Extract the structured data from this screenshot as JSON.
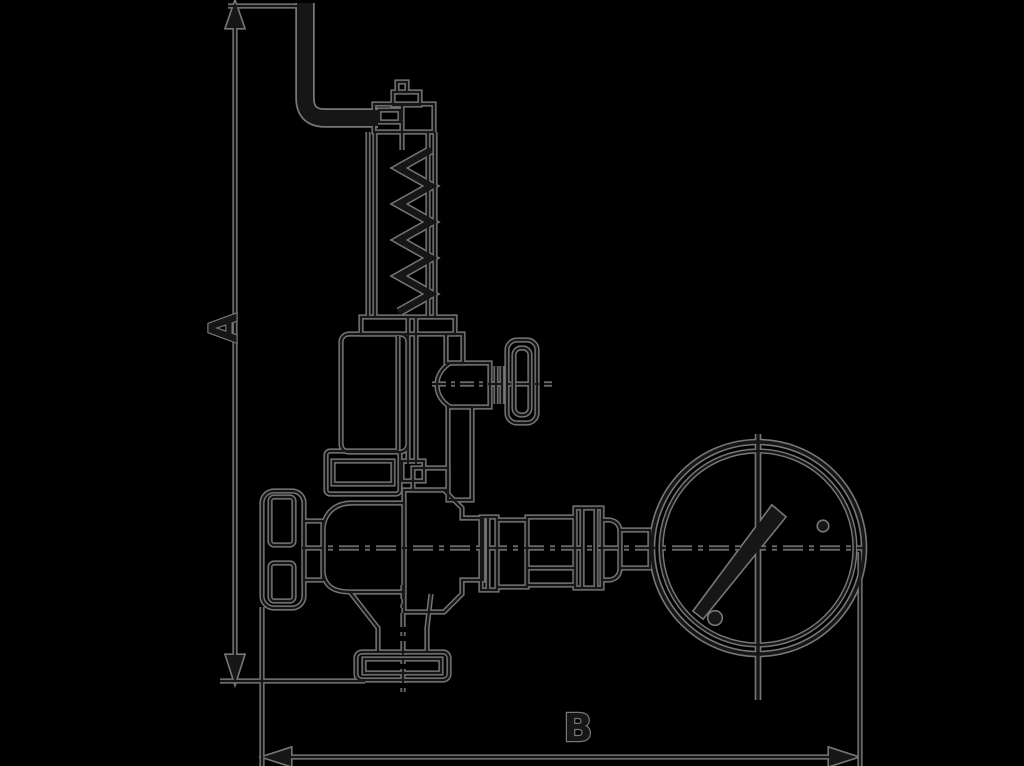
{
  "diagram": {
    "background_color": "#000000",
    "ink_color": "#161616",
    "halo_color": "#777777",
    "labels": {
      "dimension_vertical": "A",
      "dimension_horizontal": "B"
    },
    "components": [
      "easing-lever",
      "adjusting-cap",
      "spring-bonnet",
      "coil-spring",
      "upper-valve-body",
      "side-outlet",
      "side-handwheel",
      "union-nut",
      "shutoff-handwheel",
      "lower-valve-body",
      "bottom-outlet-flange",
      "gauge-piping-unions",
      "pressure-gauge",
      "gauge-needle",
      "dimension-line-A",
      "dimension-line-B"
    ]
  }
}
